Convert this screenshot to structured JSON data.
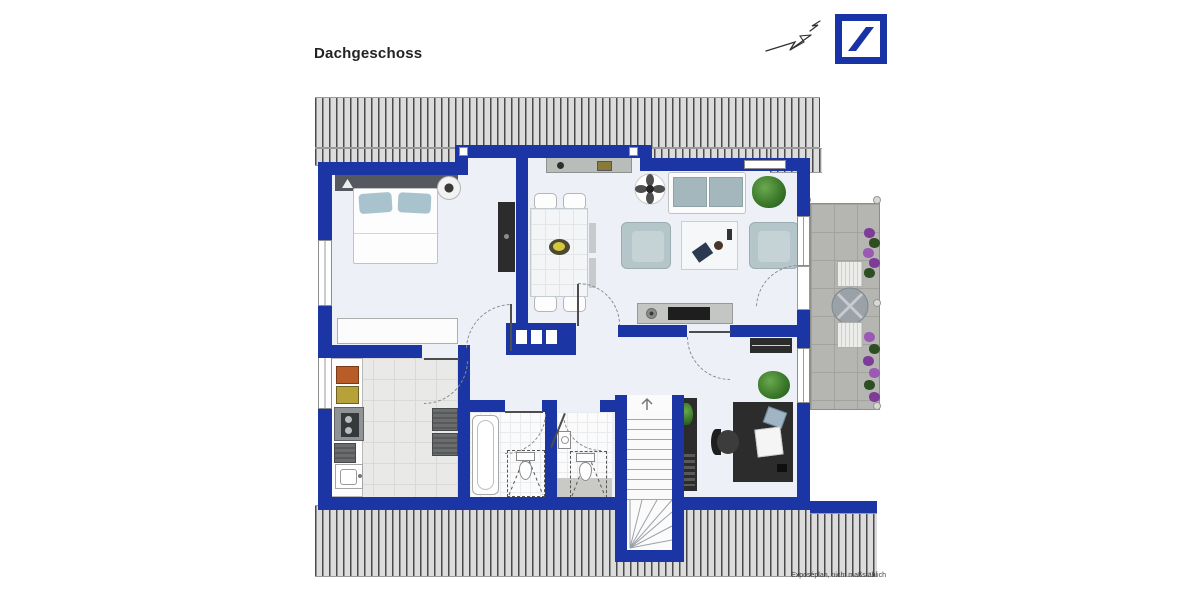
{
  "page": {
    "title": "Dachgeschoss",
    "footer_note": "Exposéplan, nicht maßstäblich"
  },
  "branding": {
    "logo_name": "deutsche-bank-slash-logo"
  },
  "icons": {
    "north_arrow": "north-arrow-sketch",
    "stairs_up": "arrow-up",
    "logo": "slash-in-square"
  },
  "colors": {
    "wall": "#1b35a4",
    "floor": "#edf1f7",
    "hatch_bg": "#dcdcdc",
    "balcony": "#b5b5b2",
    "furniture_dark": "#2c2c2c",
    "armchair": "#b5c6ca",
    "sofa_cushion": "#a4b7bc",
    "pillow": "#a9c3ce",
    "plant": "#3c7a2b",
    "flower": "#8a4a9e",
    "logo_blue": "#1733a5",
    "text": "#232323"
  }
}
